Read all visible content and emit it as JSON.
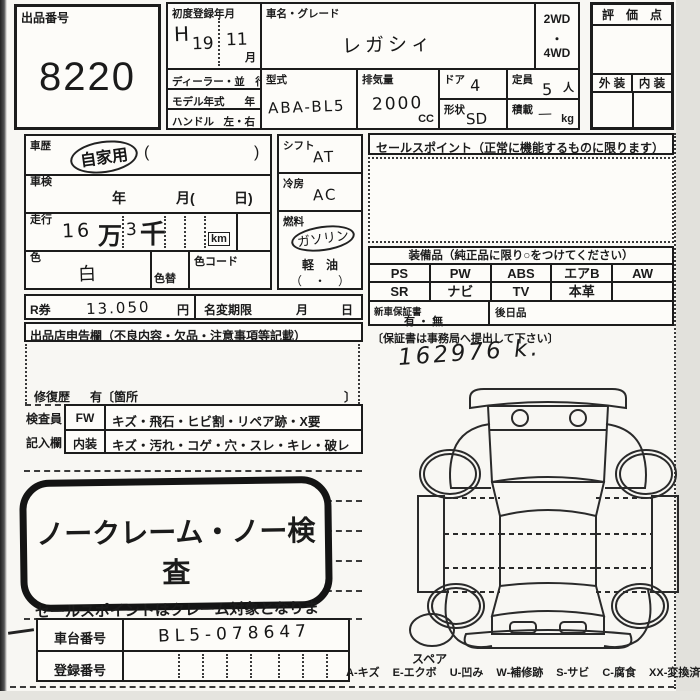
{
  "lot": {
    "label": "出品番号",
    "number": "8220"
  },
  "registration": {
    "label": "初度登録年月",
    "era": "H",
    "year": "19",
    "month": "11",
    "month_unit": "月"
  },
  "car": {
    "name_label": "車名・グレード",
    "name": "レガシィ",
    "drive_top": "2WD",
    "drive_sep": "・",
    "drive_bottom": "4WD"
  },
  "dealer": {
    "label": "ディーラー・並　行"
  },
  "model_year": {
    "label": "モデル年式",
    "unit": "年"
  },
  "handle": {
    "label": "ハンドル",
    "options": "左・右"
  },
  "model_code": {
    "label": "型式",
    "value": "ABA-BL5"
  },
  "displacement": {
    "label": "排気量",
    "value": "2000",
    "unit": "CC"
  },
  "doors": {
    "label": "ドア",
    "value": "4"
  },
  "capacity": {
    "label": "定員",
    "value": "5",
    "unit": "人"
  },
  "shape": {
    "label": "形状",
    "value": "SD"
  },
  "load": {
    "label": "積載",
    "value": "—",
    "unit": "kg"
  },
  "evaluation": {
    "title": "評　価　点",
    "exterior": "外 装",
    "interior": "内 装"
  },
  "history": {
    "label": "車歴",
    "value": "自家用",
    "paren_open": "(",
    "paren_close": ")"
  },
  "inspection": {
    "label": "車検",
    "year": "年",
    "month": "月(",
    "day": "日)"
  },
  "mileage": {
    "label": "走行",
    "first": "16",
    "man": "万",
    "second": "3",
    "sen": "千",
    "unit": "km"
  },
  "color": {
    "label": "色",
    "value": "白",
    "change_label": "色替",
    "code_label": "色コード"
  },
  "shift": {
    "label": "シフト",
    "value": "AT"
  },
  "aircon": {
    "label": "冷房",
    "value": "AC"
  },
  "fuel": {
    "label": "燃料",
    "value": "ガソリン",
    "option": "軽　油",
    "paren": "（　・　）"
  },
  "sales_point": {
    "title": "セールスポイント（正常に機能するものに限ります）"
  },
  "equipment": {
    "title": "装備品（純正品に限り○をつけてください）",
    "rows": [
      [
        "PS",
        "PW",
        "ABS",
        "エアB",
        "AW"
      ],
      [
        "SR",
        "ナビ",
        "TV",
        "本革",
        ""
      ]
    ]
  },
  "r_ticket": {
    "label": "R券",
    "amount": "13.050",
    "unit": "円",
    "deadline_label": "名変期限",
    "month": "月",
    "day": "日"
  },
  "warranty": {
    "label": "新車保証書",
    "options": "有 ・ 無",
    "later_label": "後日品",
    "note": "〔保証書は事務局へ提出して下さい〕",
    "odometer_note": "162976 k."
  },
  "declaration": {
    "title": "出品店申告欄（不良内容・欠品・注意事項等記載）",
    "repair_label": "修復歴",
    "repair_text": "有〔箇所",
    "repair_close": "〕"
  },
  "inspector": {
    "row1_label": "検査員",
    "row1_code": "FW",
    "row1_text": "キズ・飛石・ヒビ割・リペア跡・X要",
    "row2_label": "記入欄",
    "row2_code": "内装",
    "row2_text": "キズ・汚れ・コゲ・穴・スレ・キレ・破レ"
  },
  "stamp": {
    "line1": "ノークレーム・ノー検査",
    "line2": "セールスポイントはクレーム対象となります"
  },
  "chassis": {
    "label": "車台番号",
    "value": "BL5-078647"
  },
  "plate": {
    "label": "登録番号",
    "value": ""
  },
  "diagram": {
    "spare_label": "スペア"
  },
  "legend": {
    "items": [
      "A-キズ",
      "E-エクボ",
      "U-凹み",
      "W-補修跡",
      "S-サビ",
      "C-腐食",
      "XX-変換済"
    ]
  }
}
